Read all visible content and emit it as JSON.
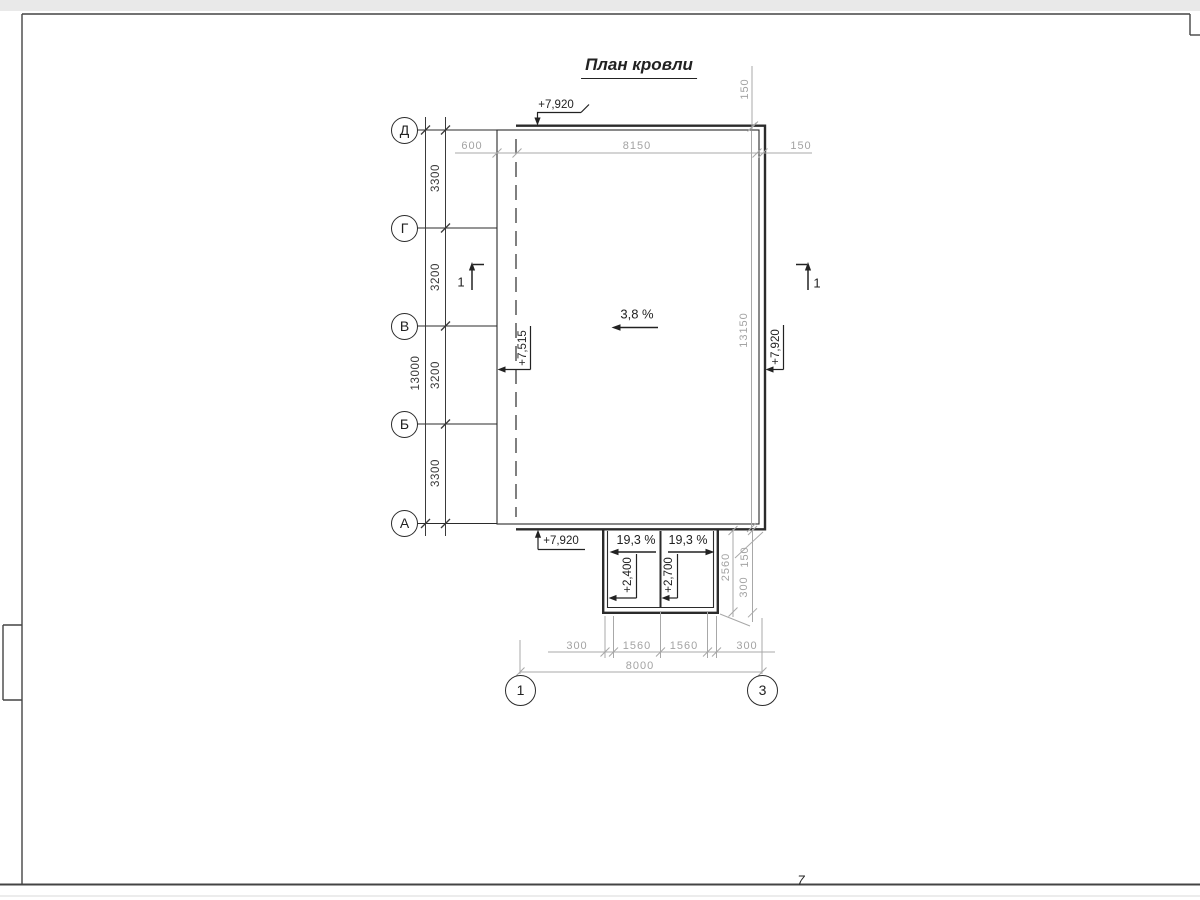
{
  "title": "План кровли",
  "page_number": "7",
  "colors": {
    "ink": "#2b2b2b",
    "dim_gray": "#a3a3a3"
  },
  "grid": {
    "row_axes": [
      {
        "label": "Д"
      },
      {
        "label": "Г"
      },
      {
        "label": "В"
      },
      {
        "label": "Б"
      },
      {
        "label": "А"
      }
    ],
    "col_axes": [
      {
        "label": "1"
      },
      {
        "label": "3"
      }
    ]
  },
  "dimensions": {
    "left": {
      "segments": [
        "3300",
        "3200",
        "3200",
        "3300"
      ],
      "overall": "13000"
    },
    "top": {
      "values": [
        "600",
        "8150",
        "150"
      ]
    },
    "top_right": {
      "overhang": "150"
    },
    "right": {
      "overall": "13150"
    },
    "canopy_right": {
      "overall": "2560",
      "top": "150",
      "bottom": "300"
    },
    "bottom": {
      "segments": [
        "300",
        "1560",
        "1560",
        "300"
      ],
      "overall": "8000"
    }
  },
  "elevations": {
    "roof_top": "+7,920",
    "roof_left": "+7,515",
    "roof_right": "+7,920",
    "roof_bottom": "+7,920",
    "canopy_left": "+2,400",
    "canopy_right": "+2,700"
  },
  "slopes": {
    "main": "3,8 %",
    "canopy_left": "19,3 %",
    "canopy_right": "19,3 %"
  },
  "section_marks": [
    {
      "label": "1"
    },
    {
      "label": "1"
    }
  ]
}
